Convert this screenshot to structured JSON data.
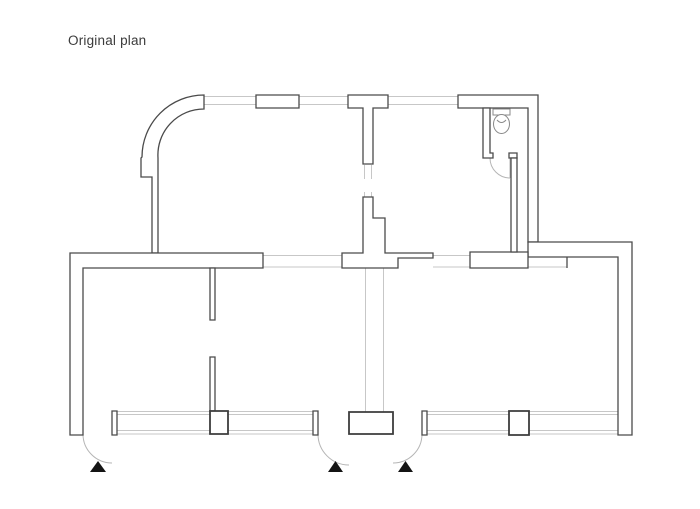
{
  "title": {
    "text": "Original plan"
  },
  "palette": {
    "background": "#ffffff",
    "wall_line": "#4a4a4a",
    "window_line": "#c7c7c7",
    "door_arc_line": "#b5b5b5",
    "entrance_marker": "#141414",
    "title_text": "#3b3b3b"
  },
  "plan": {
    "kind": "architectural floor plan",
    "icons": [
      "toilet-icon",
      "entrance-marker-triangle"
    ],
    "entrance_marker_count": 3,
    "door_count": 4,
    "window_piers": 2
  }
}
